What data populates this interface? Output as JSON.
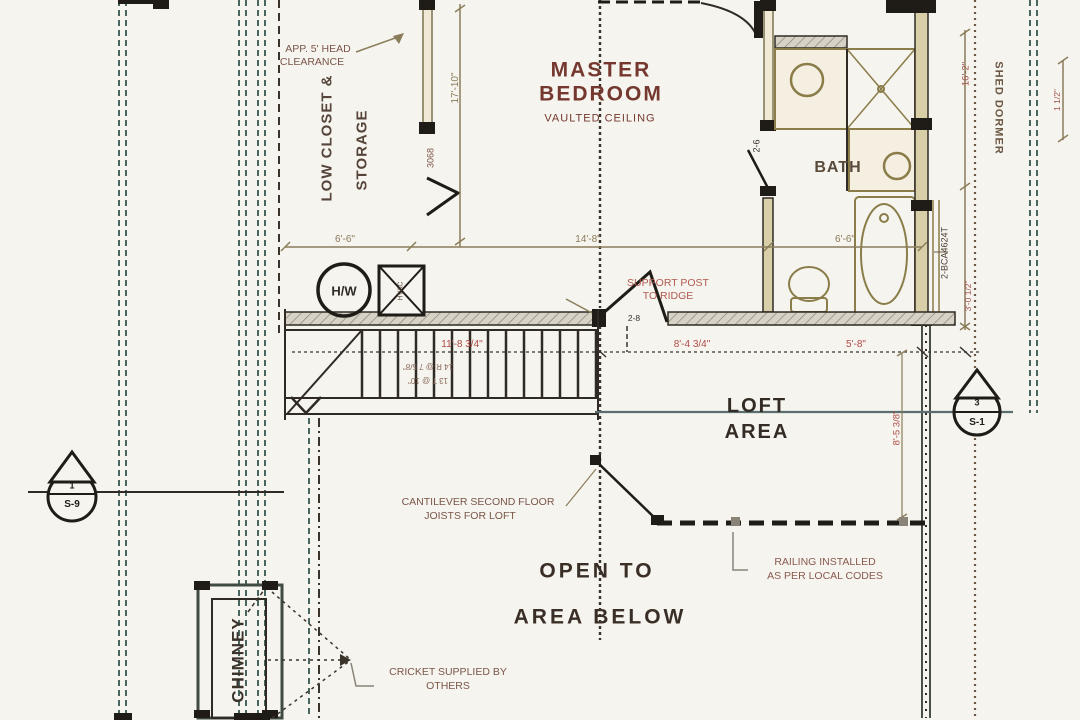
{
  "rooms": {
    "master_line1": "MASTER",
    "master_line2": "BEDROOM",
    "master_sub": "VAULTED CEILING",
    "bath": "BATH",
    "closet_line1": "LOW CLOSET &",
    "closet_line2": "STORAGE",
    "loft_line1": "LOFT",
    "loft_line2": "AREA",
    "open_line1": "OPEN TO",
    "open_line2": "AREA BELOW",
    "chimney": "CHIMNEY",
    "shed_dormer": "SHED DORMER"
  },
  "annotations": {
    "head_clearance_line1": "APP. 5' HEAD",
    "head_clearance_line2": "CLEARANCE",
    "support_line1": "SUPPORT POST",
    "support_line2": "TO RIDGE",
    "cantilever_line1": "CANTILEVER SECOND FLOOR",
    "cantilever_line2": "JOISTS FOR LOFT",
    "railing_line1": "RAILING INSTALLED",
    "railing_line2": "AS PER LOCAL CODES",
    "cricket_line1": "CRICKET SUPPLIED BY",
    "cricket_line2": "OTHERS",
    "stair_note_line1": "14 R @ 7 5/8\"",
    "stair_note_line2": "13 T @ 10\""
  },
  "equipment": {
    "water_heater": "H/W",
    "hvac": "HVAC",
    "beam": "2-BCA4624T"
  },
  "doors": {
    "closet_door": "3068",
    "bath_door": "2-6",
    "bedroom_door": "2-8"
  },
  "dimensions": {
    "closet_width": "6'-6\"",
    "bedroom_width": "14'-8\"",
    "bath_width": "6'-6\"",
    "bedroom_depth": "17'-10\"",
    "stair_run": "11'-8 3/4\"",
    "loft_dim1": "8'-4 3/4\"",
    "loft_dim2": "5'-8\"",
    "loft_depth": "8'-5 3/8\"",
    "dormer_length": "16'-2\"",
    "dormer_offset": "3'-0 1/2\"",
    "wall_offset": "1 1/2\""
  },
  "markers": {
    "left_top": "1",
    "left_bottom": "S-9",
    "right_top": "3",
    "right_bottom": "S-1"
  },
  "colors": {
    "background": "#f6f4ee",
    "wall_dark": "#241f19",
    "wall_tan": "#d8cfa8",
    "hatch_gray": "#d6d2c6",
    "teal_dash": "#49655f",
    "brown_dash": "#6b5744",
    "dim_olive": "#8a7d5a",
    "dim_red": "#b04a46",
    "label_brown": "#7a564a",
    "room_text": "#74382f",
    "fixture_tan": "#8a7d4a"
  }
}
